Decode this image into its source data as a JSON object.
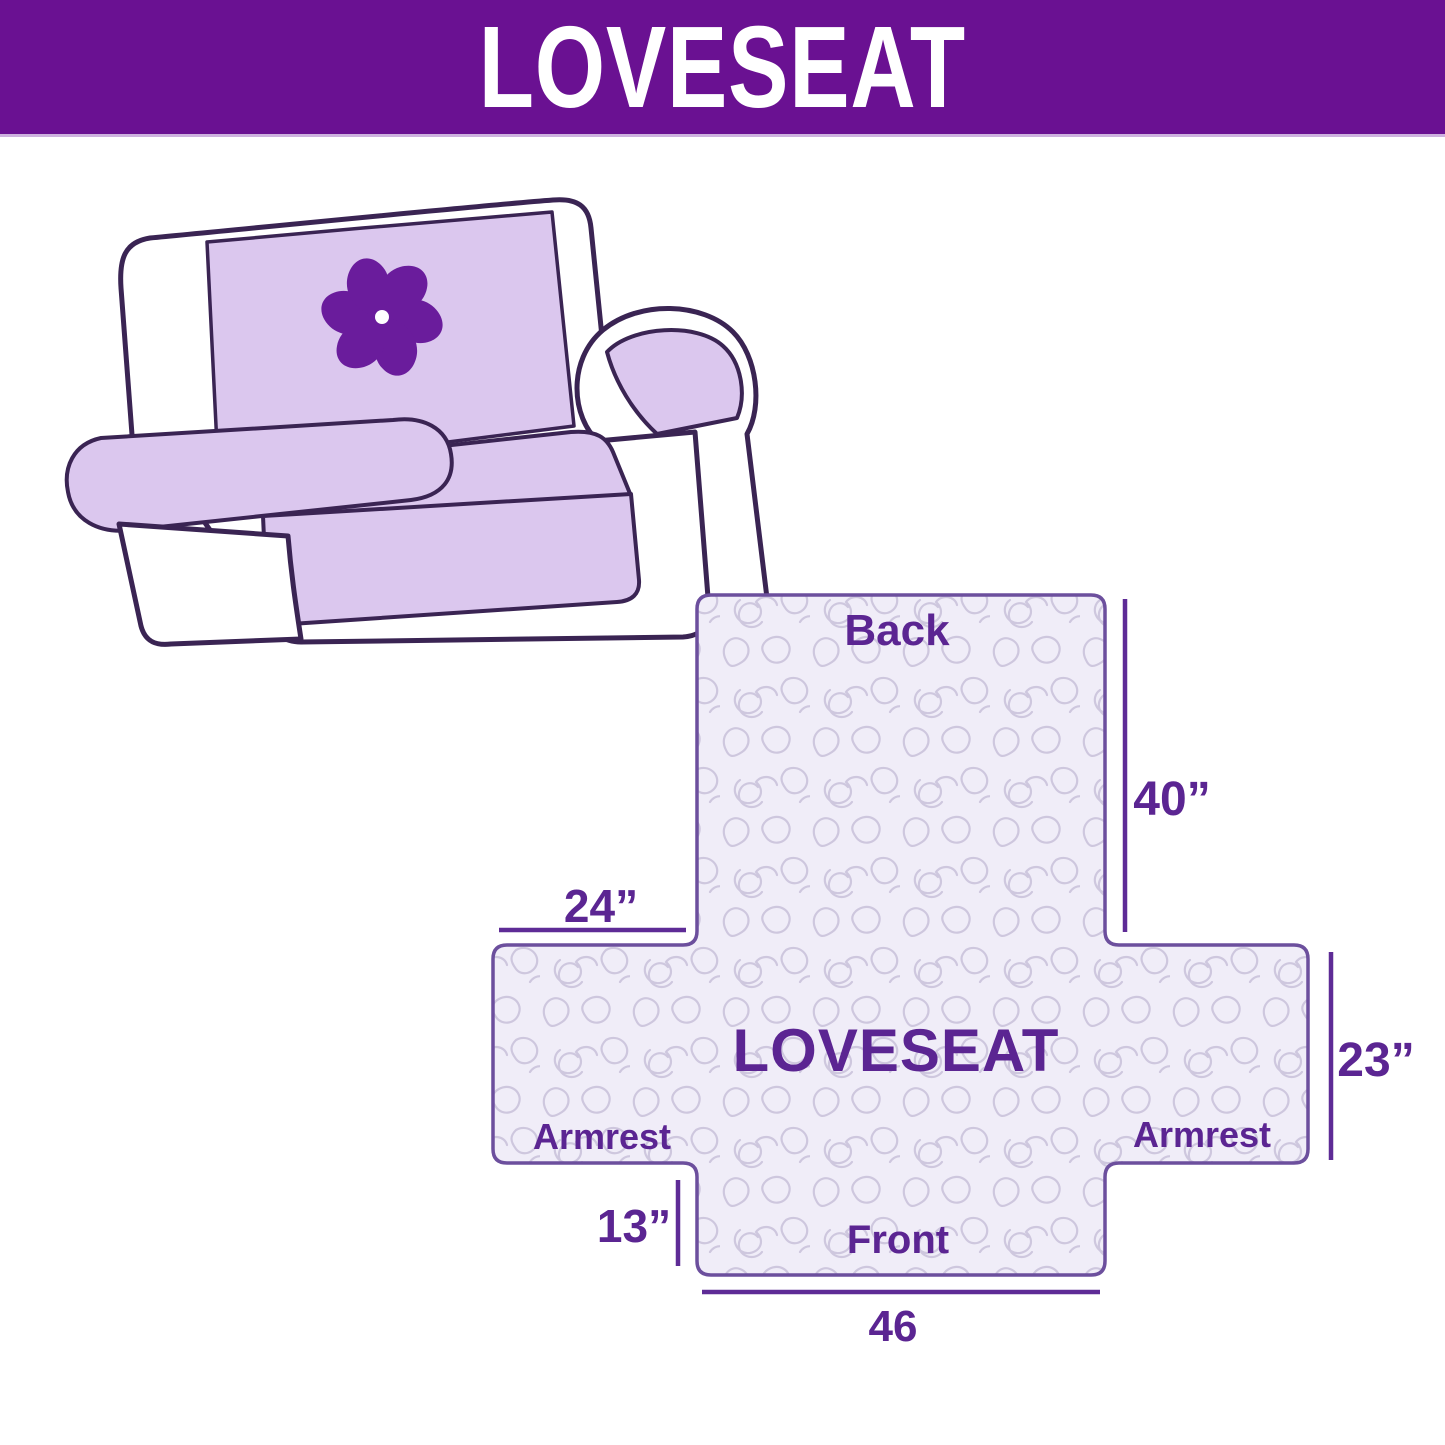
{
  "banner": {
    "title": "LOVESEAT"
  },
  "diagram": {
    "labels": {
      "back": "Back",
      "front": "Front",
      "armrest_left": "Armrest",
      "armrest_right": "Armrest",
      "center": "LOVESEAT"
    },
    "dimensions": {
      "back_height": "40”",
      "armrest_top_width": "24”",
      "armrest_side_height": "23”",
      "front_skirt_height": "13”",
      "front_width": "46"
    }
  },
  "colors": {
    "banner_bg": "#6A1192",
    "banner_text": "#FFFFFF",
    "label_text": "#5B2592",
    "dim_line": "#5E2B96",
    "shape_fill": "#F0EDF8",
    "shape_border": "#6C4F9D",
    "pattern_stroke": "#CEC7DE",
    "sofa_outline": "#3A2453",
    "cover_fill": "#DBC7EE",
    "logo_color": "#6A1C9C"
  }
}
